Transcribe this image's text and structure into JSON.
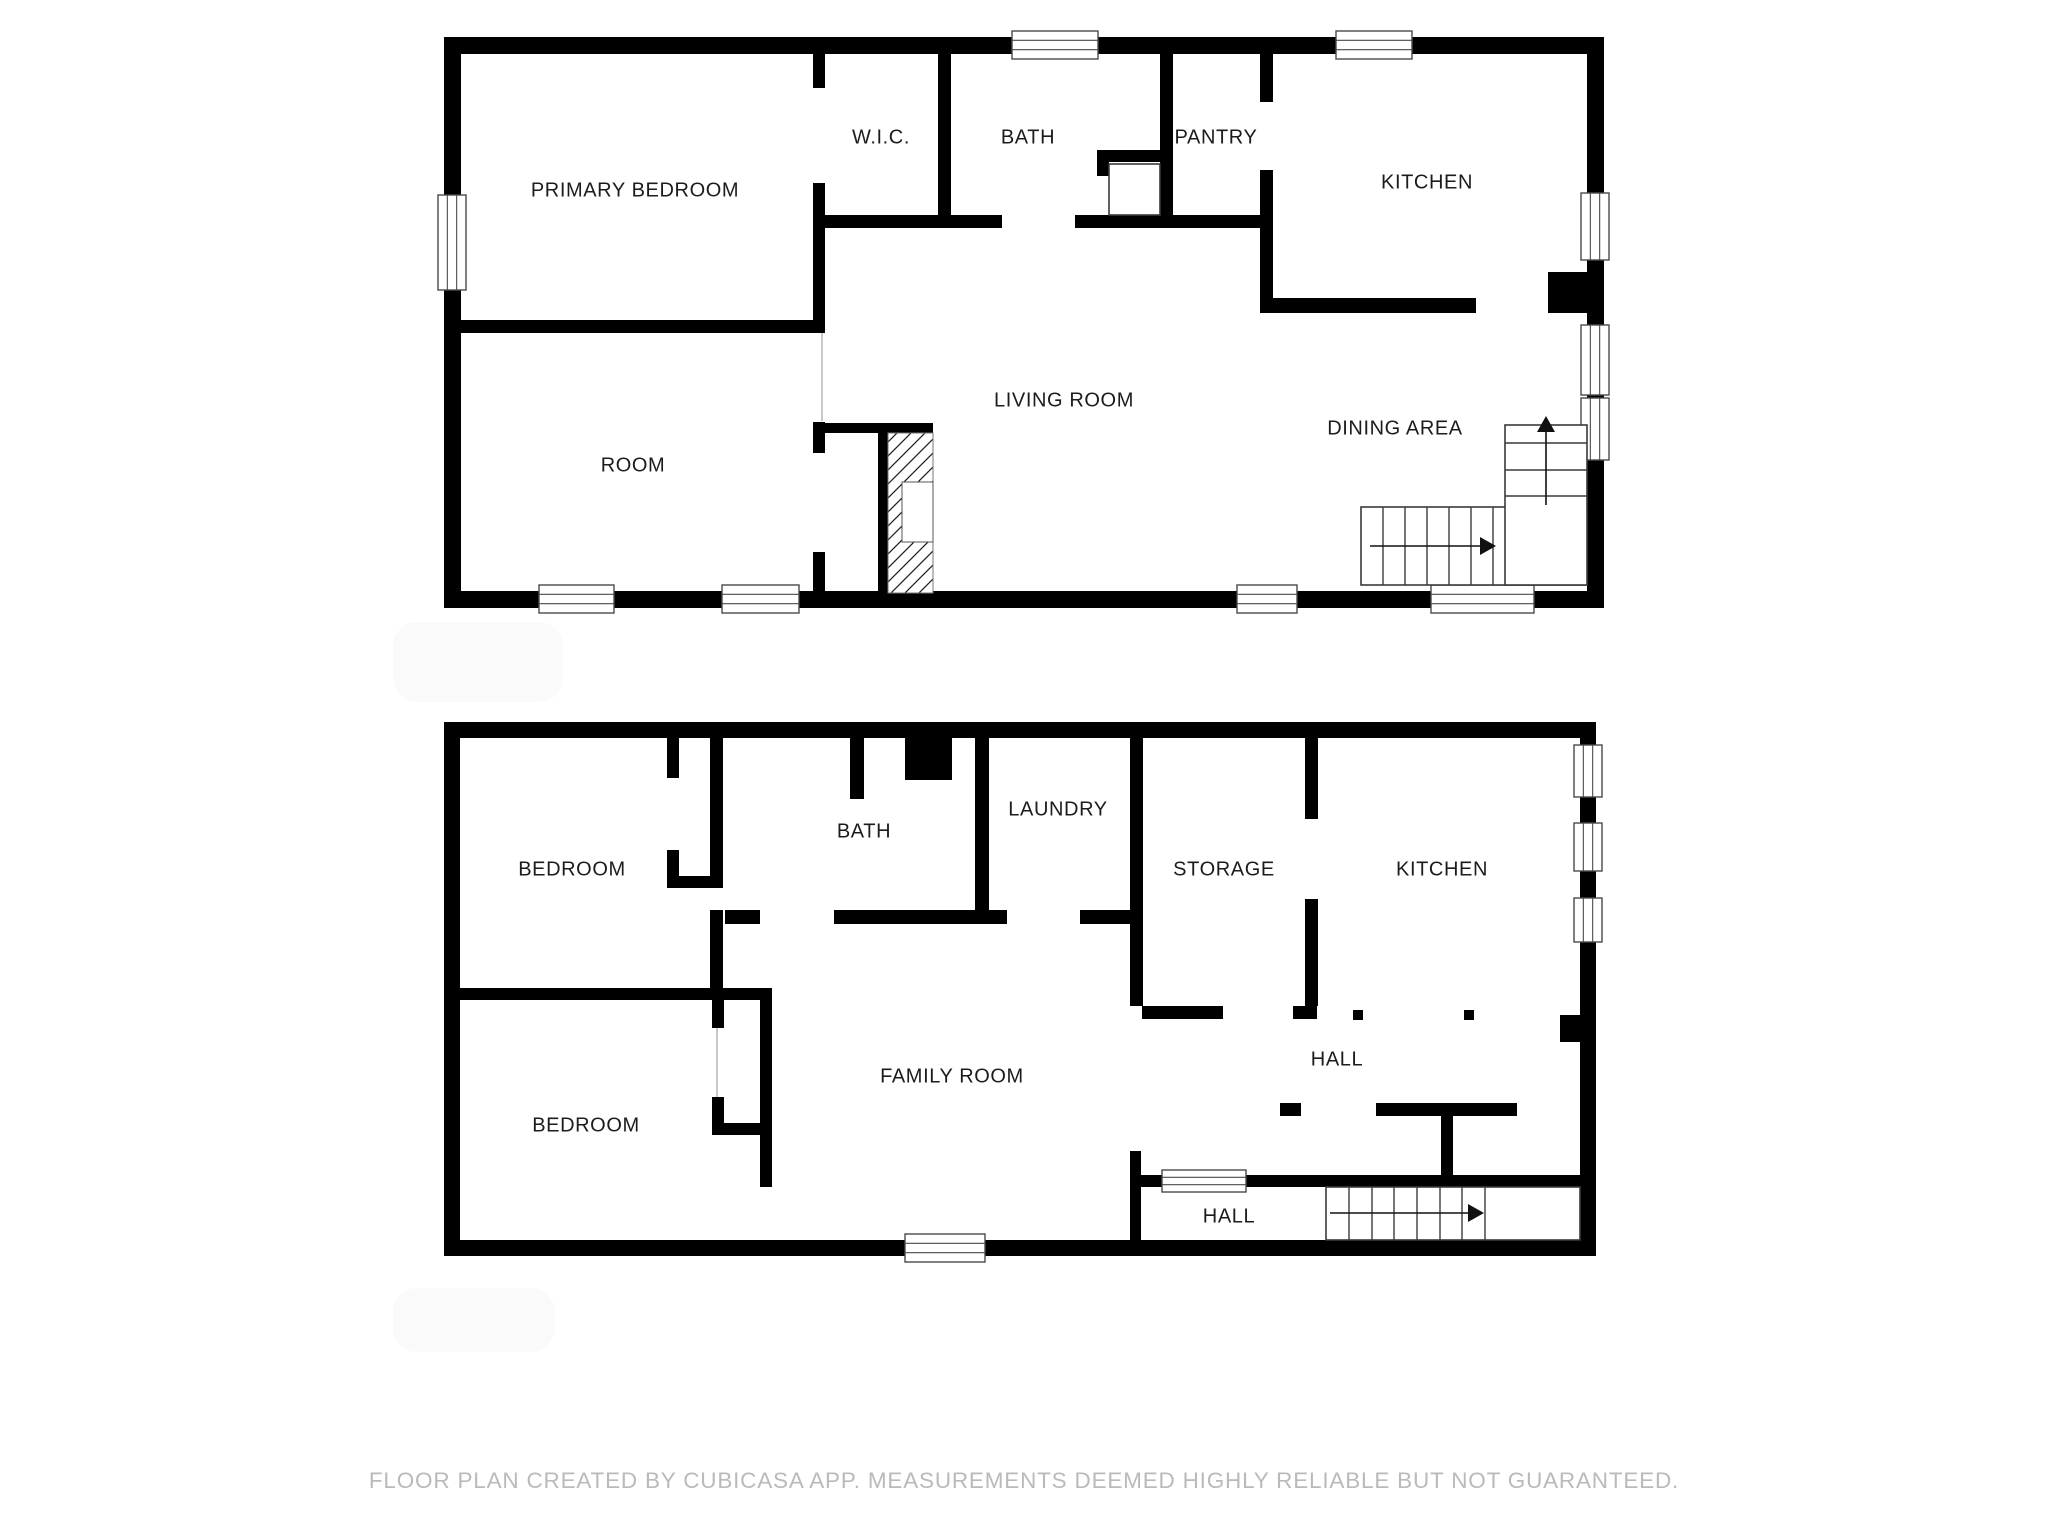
{
  "footer": {
    "text": "FLOOR PLAN CREATED BY CUBICASA APP. MEASUREMENTS DEEMED HIGHLY RELIABLE BUT NOT GUARANTEED."
  },
  "colors": {
    "wall": "#000000",
    "stair_line": "#3a3a3a",
    "window_border": "#4a4a4a",
    "door_line": "#9a9a9a",
    "label": "#1c1c1c",
    "watermark": "#fafafa",
    "background": "#ffffff"
  },
  "watermarks": [
    [
      393,
      622,
      170,
      80
    ],
    [
      393,
      1288,
      162,
      64
    ]
  ],
  "floors": [
    {
      "id": "upper-floor",
      "labels": [
        {
          "text": "PRIMARY BEDROOM",
          "x": 635,
          "y": 191
        },
        {
          "text": "ROOM",
          "x": 633,
          "y": 466
        },
        {
          "text": "W.I.C.",
          "x": 881,
          "y": 138
        },
        {
          "text": "BATH",
          "x": 1028,
          "y": 138
        },
        {
          "text": "PANTRY",
          "x": 1216,
          "y": 138
        },
        {
          "text": "KITCHEN",
          "x": 1427,
          "y": 183
        },
        {
          "text": "LIVING ROOM",
          "x": 1064,
          "y": 401
        },
        {
          "text": "DINING AREA",
          "x": 1395,
          "y": 429
        }
      ],
      "walls": [
        [
          444,
          37,
          1160,
          17
        ],
        [
          444,
          591,
          1160,
          17
        ],
        [
          444,
          37,
          17,
          571
        ],
        [
          1587,
          37,
          17,
          571
        ],
        [
          813,
          54,
          12,
          34
        ],
        [
          813,
          183,
          12,
          150
        ],
        [
          813,
          422,
          12,
          31
        ],
        [
          813,
          552,
          12,
          41
        ],
        [
          461,
          320,
          352,
          13
        ],
        [
          825,
          215,
          177,
          13
        ],
        [
          1075,
          215,
          198,
          13
        ],
        [
          938,
          54,
          13,
          161
        ],
        [
          1160,
          54,
          13,
          161
        ],
        [
          1097,
          150,
          75,
          12
        ],
        [
          1097,
          162,
          12,
          14
        ],
        [
          1260,
          54,
          13,
          48
        ],
        [
          1260,
          170,
          13,
          143
        ],
        [
          1260,
          298,
          216,
          15
        ],
        [
          823,
          423,
          110,
          10
        ],
        [
          878,
          423,
          10,
          170
        ],
        [
          902,
          475,
          31,
          7
        ],
        [
          902,
          542,
          31,
          7
        ],
        [
          1548,
          272,
          40,
          41
        ]
      ],
      "hatch_rects": [
        [
          888,
          433,
          45,
          160
        ]
      ],
      "white_insets": [
        [
          902,
          482,
          31,
          60
        ]
      ],
      "thin_rects": [
        [
          1361,
          507,
          226,
          78
        ],
        [
          1505,
          425,
          82,
          160
        ],
        [
          1109,
          164,
          51,
          51
        ]
      ],
      "windows": [
        [
          1012,
          31,
          86,
          28
        ],
        [
          1336,
          31,
          76,
          28
        ],
        [
          539,
          585,
          75,
          28
        ],
        [
          722,
          585,
          77,
          28
        ],
        [
          1237,
          585,
          60,
          28
        ],
        [
          1431,
          585,
          103,
          28
        ],
        [
          438,
          195,
          28,
          95
        ],
        [
          1581,
          193,
          28,
          67
        ],
        [
          1581,
          325,
          28,
          70
        ],
        [
          1581,
          398,
          28,
          62
        ]
      ],
      "lines": [
        [
          1505,
          443,
          1587,
          443
        ],
        [
          1505,
          470,
          1587,
          470
        ],
        [
          1505,
          496,
          1587,
          496
        ],
        [
          1383,
          507,
          1383,
          585
        ],
        [
          1405,
          507,
          1405,
          585
        ],
        [
          1427,
          507,
          1427,
          585
        ],
        [
          1449,
          507,
          1449,
          585
        ],
        [
          1471,
          507,
          1471,
          585
        ],
        [
          1493,
          507,
          1493,
          585
        ]
      ],
      "door_lines": [
        [
          822,
          333,
          822,
          421
        ]
      ],
      "arrows": [
        [
          1370,
          546,
          1480,
          546
        ],
        [
          1546,
          505,
          1546,
          432
        ]
      ],
      "dots": []
    },
    {
      "id": "lower-floor",
      "labels": [
        {
          "text": "BEDROOM",
          "x": 572,
          "y": 870
        },
        {
          "text": "BATH",
          "x": 864,
          "y": 832
        },
        {
          "text": "LAUNDRY",
          "x": 1058,
          "y": 810
        },
        {
          "text": "STORAGE",
          "x": 1224,
          "y": 870
        },
        {
          "text": "KITCHEN",
          "x": 1442,
          "y": 870
        },
        {
          "text": "HALL",
          "x": 1337,
          "y": 1060
        },
        {
          "text": "FAMILY ROOM",
          "x": 952,
          "y": 1077
        },
        {
          "text": "BEDROOM",
          "x": 586,
          "y": 1126
        },
        {
          "text": "HALL",
          "x": 1229,
          "y": 1217
        }
      ],
      "walls": [
        [
          444,
          722,
          1152,
          16
        ],
        [
          444,
          1240,
          1152,
          16
        ],
        [
          444,
          722,
          16,
          534
        ],
        [
          1580,
          722,
          16,
          534
        ],
        [
          905,
          722,
          47,
          58
        ],
        [
          667,
          738,
          12,
          40
        ],
        [
          667,
          850,
          12,
          38
        ],
        [
          667,
          876,
          55,
          12
        ],
        [
          710,
          738,
          13,
          150
        ],
        [
          710,
          910,
          13,
          78
        ],
        [
          460,
          988,
          312,
          12
        ],
        [
          850,
          738,
          14,
          61
        ],
        [
          725,
          910,
          35,
          14
        ],
        [
          834,
          910,
          173,
          14
        ],
        [
          1080,
          910,
          50,
          14
        ],
        [
          975,
          738,
          14,
          172
        ],
        [
          1130,
          738,
          13,
          268
        ],
        [
          1142,
          1006,
          81,
          13
        ],
        [
          1293,
          1006,
          24,
          13
        ],
        [
          1305,
          738,
          13,
          81
        ],
        [
          1305,
          899,
          13,
          107
        ],
        [
          1130,
          1151,
          11,
          105
        ],
        [
          1280,
          1103,
          21,
          13
        ],
        [
          1376,
          1103,
          68,
          13
        ],
        [
          1444,
          1103,
          73,
          13
        ],
        [
          1441,
          1116,
          12,
          60
        ],
        [
          1287,
          1175,
          309,
          12
        ],
        [
          1139,
          1175,
          148,
          12
        ],
        [
          1560,
          1015,
          36,
          27
        ],
        [
          712,
          1000,
          12,
          28
        ],
        [
          712,
          1097,
          12,
          38
        ],
        [
          712,
          1123,
          60,
          12
        ],
        [
          760,
          988,
          12,
          199
        ]
      ],
      "hatch_rects": [],
      "white_insets": [],
      "thin_rects": [
        [
          1326,
          1187,
          254,
          53
        ]
      ],
      "windows": [
        [
          1574,
          745,
          28,
          52
        ],
        [
          1574,
          823,
          28,
          48
        ],
        [
          1574,
          898,
          28,
          44
        ],
        [
          1162,
          1170,
          84,
          22
        ],
        [
          905,
          1234,
          80,
          28
        ]
      ],
      "lines": [
        [
          1349,
          1187,
          1349,
          1240
        ],
        [
          1372,
          1187,
          1372,
          1240
        ],
        [
          1394,
          1187,
          1394,
          1240
        ],
        [
          1417,
          1187,
          1417,
          1240
        ],
        [
          1440,
          1187,
          1440,
          1240
        ],
        [
          1462,
          1187,
          1462,
          1240
        ],
        [
          1485,
          1187,
          1485,
          1240
        ]
      ],
      "door_lines": [
        [
          717,
          1028,
          717,
          1097
        ]
      ],
      "arrows": [
        [
          1330,
          1213,
          1468,
          1213
        ]
      ],
      "dots": [
        [
          1353,
          1010,
          10,
          10
        ],
        [
          1464,
          1010,
          10,
          10
        ]
      ]
    }
  ]
}
